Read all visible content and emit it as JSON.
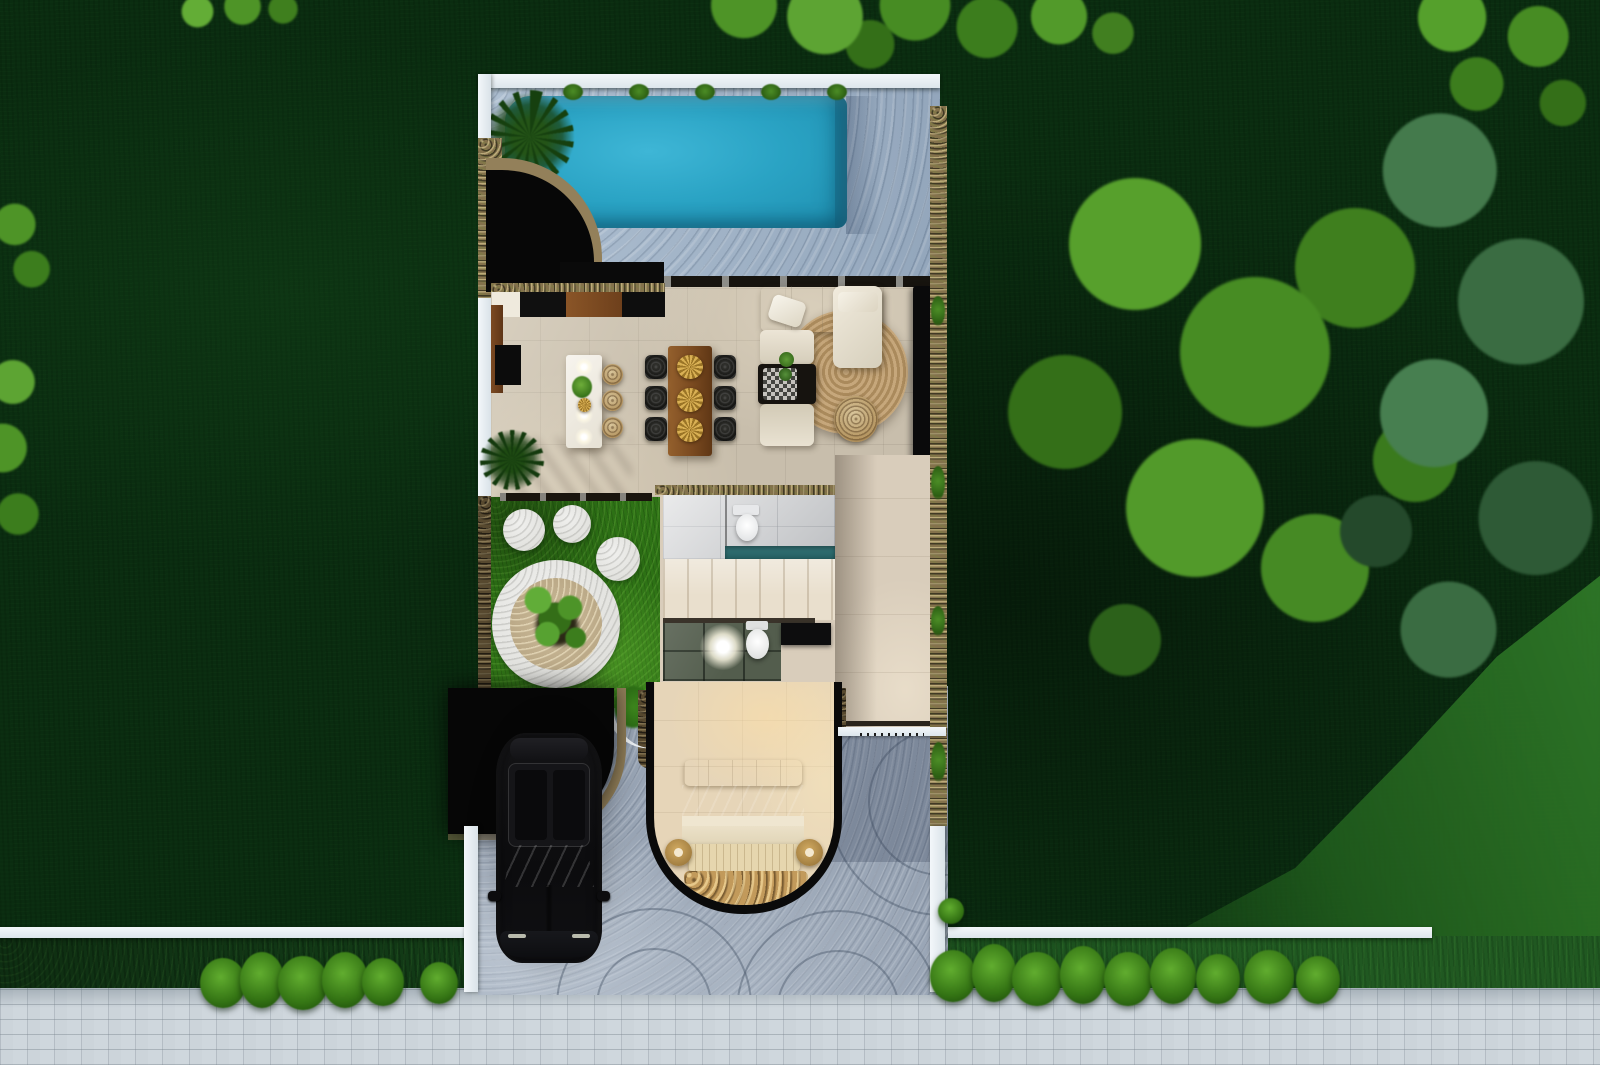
{
  "scene": {
    "title": "Aerial top-down 3D render of a narrow villa lot floor plan",
    "visible_text": "none",
    "environment": {
      "lawn": {
        "name": "surrounding-lawn",
        "tone_dark": "#0a2c10",
        "tone_shadow": "#07230c",
        "tone_sunlit": "#2b7a26"
      },
      "trees": [
        {
          "name": "tree-top-left-small",
          "tone": "bright-green"
        },
        {
          "name": "tree-top-center",
          "tone": "bright-green"
        },
        {
          "name": "tree-top-right-corner",
          "tone": "bright-green"
        },
        {
          "name": "tree-right-large-bright",
          "tone": "bright-green"
        },
        {
          "name": "tree-right-large-teal",
          "tone": "dark-teal-green"
        },
        {
          "name": "tree-left-edge-upper",
          "tone": "green"
        },
        {
          "name": "tree-left-edge-lower",
          "tone": "bright-green"
        }
      ],
      "street": {
        "sidewalk": {
          "name": "paver-sidewalk",
          "color": "#c6cfd6",
          "pattern": "running-bond"
        },
        "hedge_strip": {
          "color": "#16471b"
        },
        "boundary_walls": {
          "color": "#edf2f5",
          "segments": [
            "left-of-driveway",
            "right-of-driveway"
          ]
        },
        "bushes": {
          "count": 16,
          "color": "#347414"
        }
      }
    },
    "lot": {
      "pool_zone": {
        "pool": {
          "name": "swimming-pool",
          "water_color": "#2ba4c6",
          "deep_color": "#1d8cac",
          "shape": "rounded-rectangle"
        },
        "deck": {
          "name": "pool-deck",
          "color": "#a6b9cd",
          "texture": "cobblestone"
        },
        "edge_plants": {
          "count": 5
        },
        "palm_tree": 1,
        "shade_corner": {
          "name": "black-shade-corner",
          "color": "#070707",
          "edge": "curved-stone-band"
        }
      },
      "living_dining": {
        "floor_color": "#c8beac",
        "kitchen": {
          "counter_segments": [
            "white",
            "black",
            "wood",
            "black"
          ],
          "island_color": "#f3f0e9",
          "bar_stools": 3,
          "pendant_lights": 4
        },
        "dining": {
          "table_color": "#804c24",
          "chairs": 6,
          "gold_platters": 3
        },
        "lounge": {
          "sofa_color": "#e7e0d0",
          "pillows": 2,
          "coffee_table": "black-with-plants",
          "rug": "round-jute",
          "rug_color": "#bf9f72",
          "pouf": "wicker",
          "tv_console_color": "#0b0b0c"
        },
        "floor_plants": 1
      },
      "patio_garden": {
        "grass_color": "#2d7115",
        "paw_print_stones": {
          "large_pad": 1,
          "toe_stones": 3,
          "stone_color": "#e1e1dd"
        },
        "gravel_circle_color": "#c8b795",
        "courtyard_tree": 1
      },
      "bath_block": {
        "upper_bathroom": {
          "tiles": "#d5d6d8",
          "toilet": 1,
          "shower_strip_color": "#2e6d70"
        },
        "staircase": {
          "treads": 7,
          "color": "#e9dfcd"
        },
        "lower_bathroom": {
          "tiles": "#535d4d",
          "toilet": 1,
          "vanity_color": "#0e0e0e",
          "ceiling_light_glow": 1
        },
        "hallway_color": "#d9cdbb"
      },
      "bedroom": {
        "enclosure": {
          "shape": "U-curved-wall",
          "color": "#0a0a0a"
        },
        "floor_color": "#e6d5b8",
        "bed": {
          "pillows": "cream",
          "throw_color": "#87765f",
          "duvet": "cream",
          "foot_bench": 1
        },
        "side_poufs": 2,
        "pouf_color": "#c8a45f",
        "pebble_rug_color": "#c29a5b"
      },
      "driveway": {
        "surface_color": "#98a4b4",
        "stamped_pattern": "fan-arcs",
        "car": {
          "body_color": "#101012",
          "hood_tint": "#3c4c33",
          "orientation": "nose-toward-street"
        },
        "carport_canopy_color": "#060606",
        "gate_line": {
          "color": "#eef2f5",
          "tick_marks": true
        }
      },
      "walls": {
        "outer_white": "#edf2f5",
        "stone_borders": "#84724c"
      }
    }
  }
}
